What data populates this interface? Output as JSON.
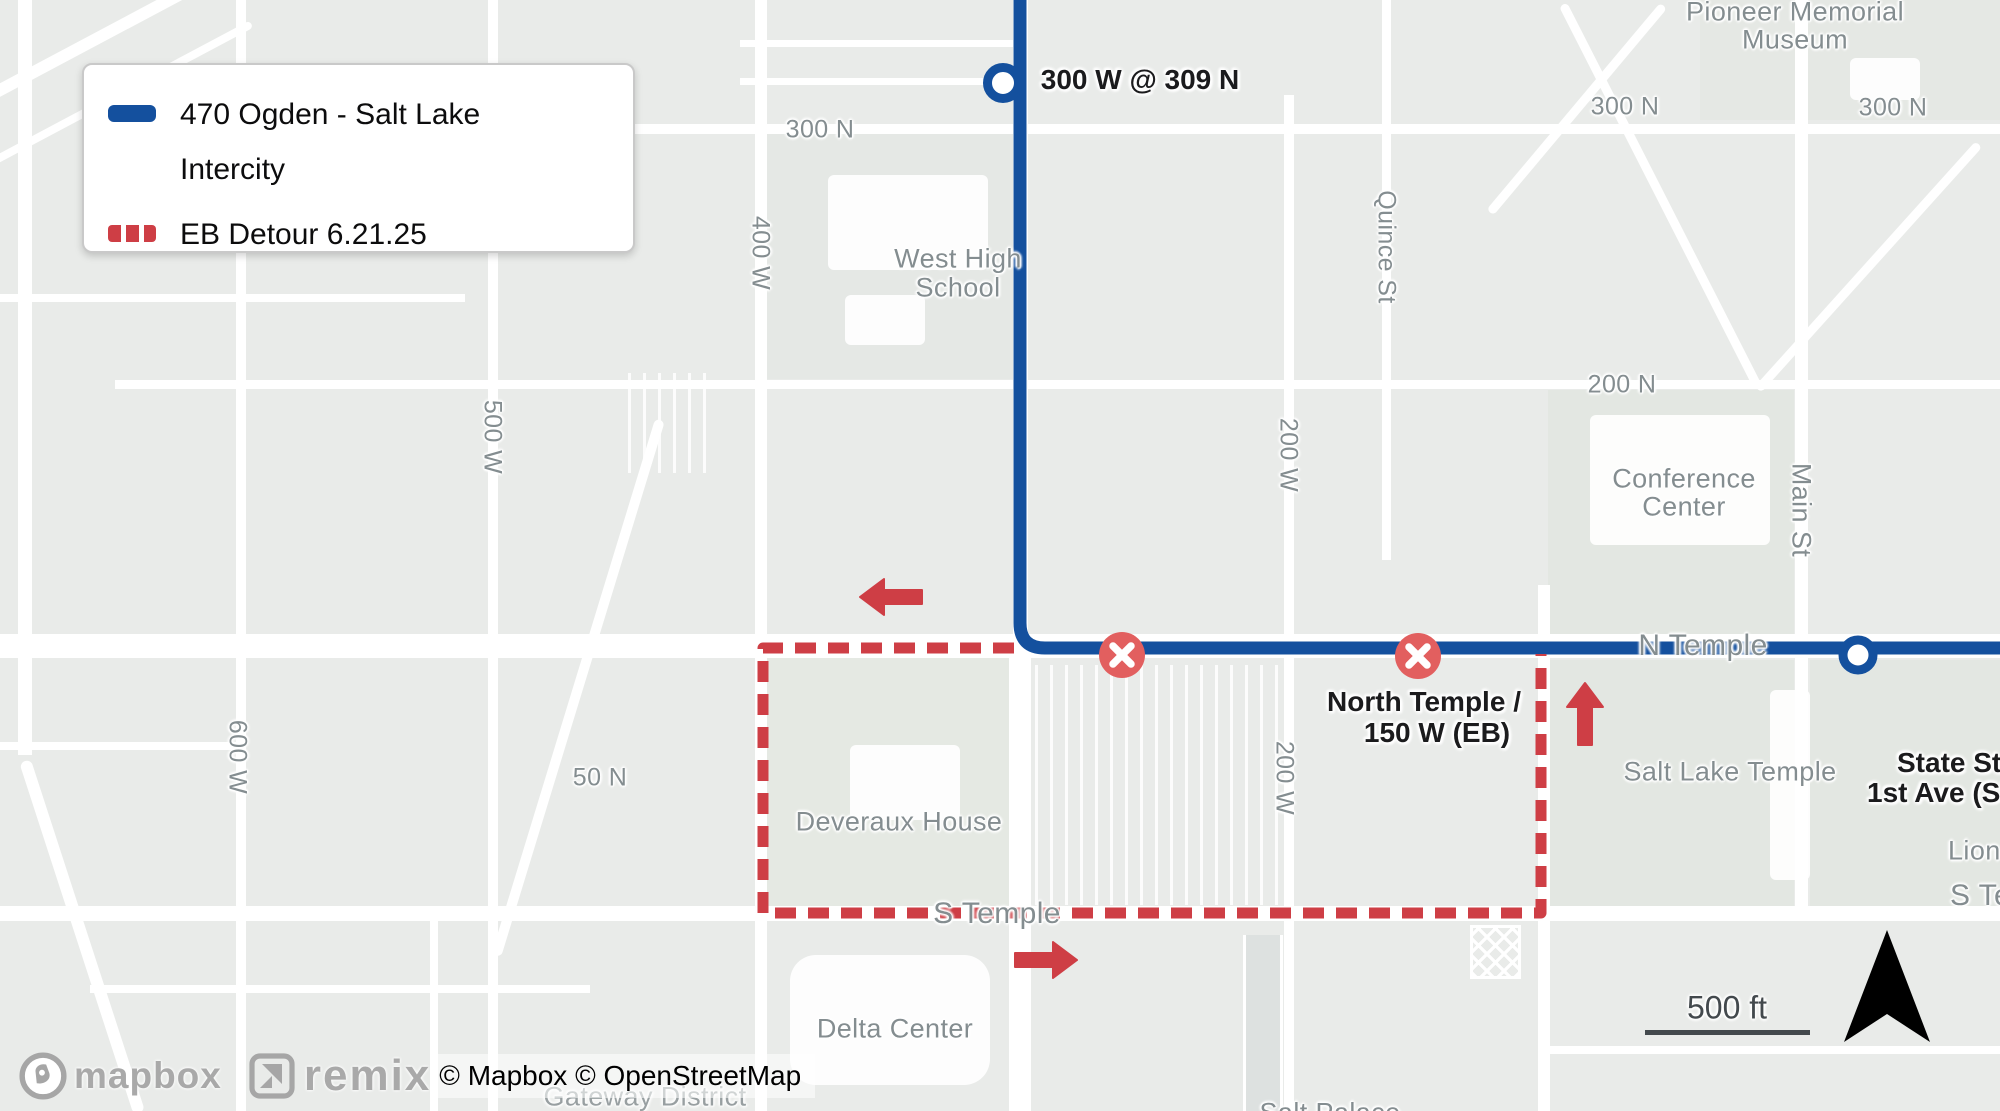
{
  "colors": {
    "route-blue": "#14509e",
    "detour-red": "#ce3e45",
    "closed-red": "#e25f5f",
    "label-gray": "#848d90",
    "stop-label": "#1b1b1d",
    "scale-dark": "#43494d"
  },
  "legend": {
    "route_label": "470 Ogden - Salt Lake Intercity",
    "detour_label": "EB Detour 6.21.25"
  },
  "map_labels": {
    "streets": [
      "300 N",
      "400 W",
      "West High",
      "School",
      "500 W",
      "600 W",
      "Quince St",
      "200 W",
      "200 N",
      "300 N",
      "300 N",
      "Pioneer Memorial",
      "Museum",
      "Conference",
      "Center",
      "Main St",
      "N Temple",
      "50 N",
      "Deveraux House",
      "S Temple",
      "200 W",
      "Salt Lake Temple",
      "Lion H",
      "S Tem",
      "Delta Center",
      "Gateway District",
      "Salt Palace"
    ],
    "stops": [
      "300 W @ 309 N",
      "North Temple /",
      "150 W (EB)",
      "State St",
      "1st Ave (SB"
    ]
  },
  "scale": {
    "label": "500 ft"
  },
  "attribution": {
    "mapbox_label": "mapbox",
    "remix_label": "remix",
    "text": "© Mapbox © OpenStreetMap"
  }
}
